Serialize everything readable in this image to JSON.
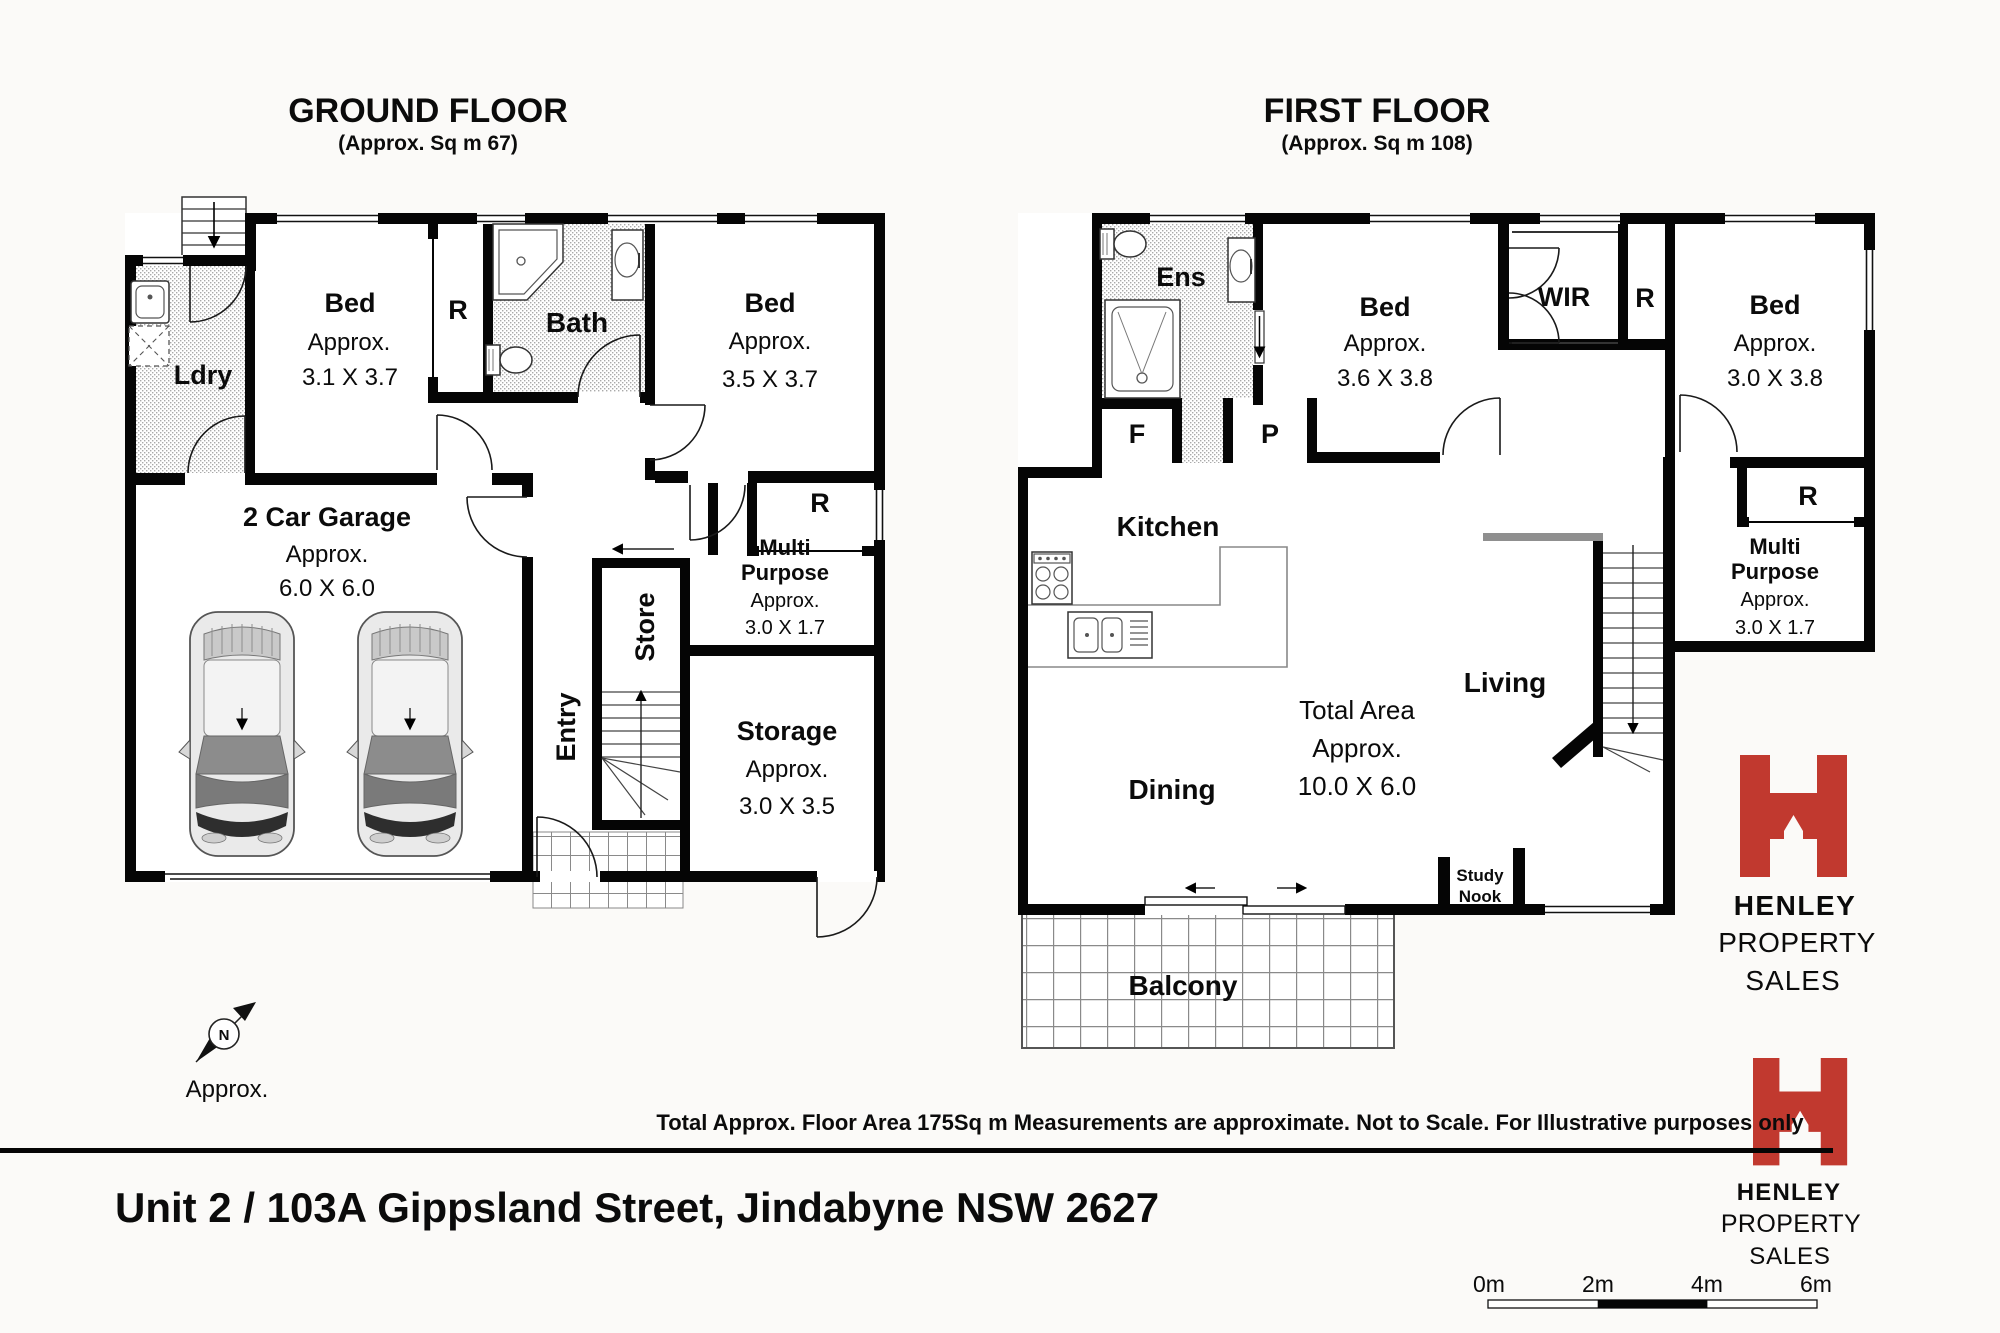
{
  "ground_floor": {
    "title": "GROUND FLOOR",
    "subtitle": "(Approx. Sq m 67)",
    "rooms": {
      "laundry": {
        "label": "Ldry"
      },
      "bed1": {
        "label": "Bed",
        "line2": "Approx.",
        "line3": "3.1 X 3.7"
      },
      "robe1": {
        "label": "R"
      },
      "bath": {
        "label": "Bath"
      },
      "bed2": {
        "label": "Bed",
        "line2": "Approx.",
        "line3": "3.5 X 3.7"
      },
      "garage": {
        "label": "2 Car Garage",
        "line2": "Approx.",
        "line3": "6.0 X 6.0"
      },
      "entry": {
        "label": "Entry"
      },
      "store": {
        "label": "Store"
      },
      "robe2": {
        "label": "R"
      },
      "multi_purpose": {
        "label1": "Multi",
        "label2": "Purpose",
        "line3": "Approx.",
        "line4": "3.0 X 1.7"
      },
      "storage": {
        "label": "Storage",
        "line2": "Approx.",
        "line3": "3.0 X 3.5"
      }
    }
  },
  "first_floor": {
    "title": "FIRST FLOOR",
    "subtitle": "(Approx. Sq m 108)",
    "rooms": {
      "ensuite": {
        "label": "Ens"
      },
      "fridge": {
        "label": "F"
      },
      "pantry": {
        "label": "P"
      },
      "bed3": {
        "label": "Bed",
        "line2": "Approx.",
        "line3": "3.6 X 3.8"
      },
      "wir": {
        "label": "WIR"
      },
      "robe3": {
        "label": "R"
      },
      "bed4": {
        "label": "Bed",
        "line2": "Approx.",
        "line3": "3.0 X 3.8"
      },
      "kitchen": {
        "label": "Kitchen"
      },
      "robe4": {
        "label": "R"
      },
      "multi_purpose": {
        "label1": "Multi",
        "label2": "Purpose",
        "line3": "Approx.",
        "line4": "3.0 X 1.7"
      },
      "dining": {
        "label": "Dining"
      },
      "living": {
        "label": "Living"
      },
      "total_area": {
        "line1": "Total Area",
        "line2": "Approx.",
        "line3": "10.0 X 6.0"
      },
      "study_nook": {
        "line1": "Study",
        "line2": "Nook"
      },
      "balcony": {
        "label": "Balcony"
      }
    }
  },
  "compass": {
    "label": "Approx."
  },
  "footer": {
    "disclaimer": "Total Approx. Floor Area 175Sq m Measurements are approximate. Not to Scale. For Illustrative purposes only",
    "address": "Unit 2 / 103A Gippsland Street, Jindabyne NSW  2627"
  },
  "brand": {
    "line1": "HENLEY",
    "line2": "PROPERTY",
    "line3": "SALES",
    "color": "#c1392f"
  },
  "scale_bar": {
    "labels": [
      "0m",
      "2m",
      "4m",
      "6m"
    ]
  }
}
